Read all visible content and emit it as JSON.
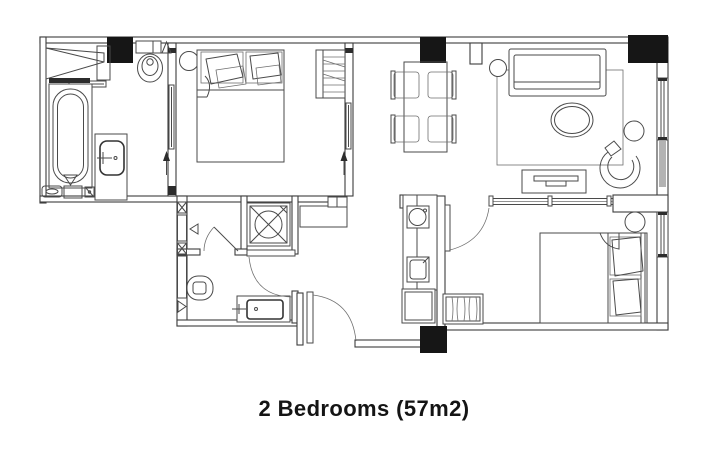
{
  "caption": {
    "text": "2 Bedrooms (57m2)",
    "color": "#141414"
  },
  "plan": {
    "type": "apartment-floor-plan",
    "bedroom_count_shown": "2",
    "area_shown": "57m2",
    "line_color": "#4a4a4a",
    "wall_color": "#3d3d3d",
    "column_fill": "#161616",
    "window_shade_fill": "#b3b3b3",
    "window_shade_stroke": "#7d7d7d",
    "background": "#ffffff",
    "fixture_icons": [
      "bathtub-icon",
      "vanity-sink-icon",
      "toilet-icon",
      "wardrobe-icon",
      "double-bed-icon",
      "nightstand-icon",
      "dining-table-icon",
      "dining-chair-icon",
      "sofa-icon",
      "coffee-table-icon",
      "armchair-icon",
      "side-table-icon",
      "tv-console-icon",
      "shower-stall-icon",
      "kitchen-sink-icon",
      "cooktop-icon",
      "base-cabinet-icon",
      "luggage-rack-icon",
      "door-swing-icon",
      "sliding-door-icon",
      "window-icon",
      "column-icon"
    ]
  }
}
